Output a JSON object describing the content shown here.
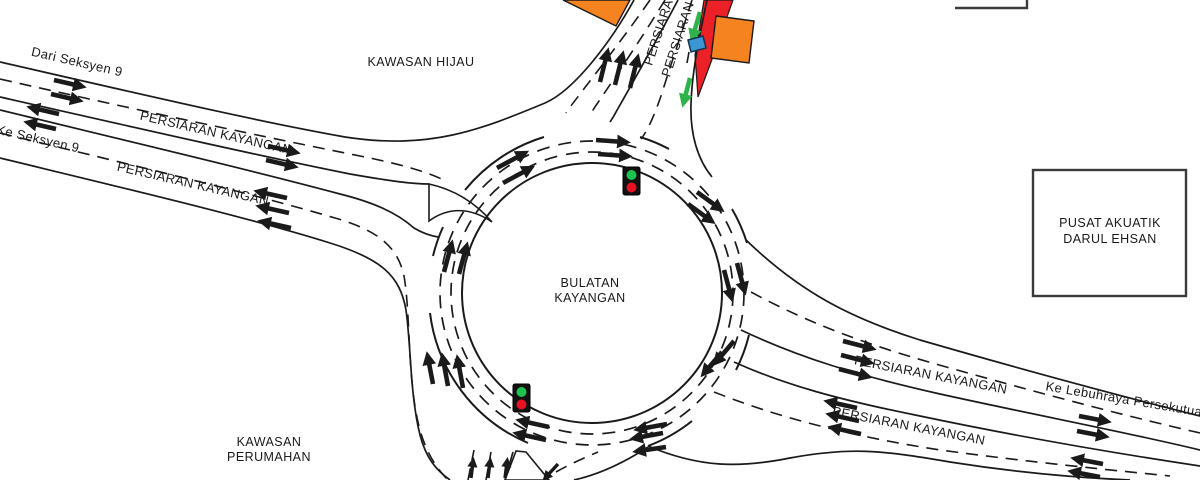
{
  "title": "Bulatan Kayangan roundabout traffic diagram",
  "palette": {
    "orange": "#F5831F",
    "red": "#EC2027",
    "green": "#2DB34A",
    "blue": "#3D96D4",
    "signal_green": "#1DC24F",
    "signal_red": "#E81123"
  },
  "areas": {
    "kawasan_hijau": "KAWASAN HIJAU",
    "kawasan_perumahan_line1": "KAWASAN",
    "kawasan_perumahan_line2": "PERUMAHAN",
    "pusat_akuatik_line1": "PUSAT AKUATIK",
    "pusat_akuatik_line2": "DARUL EHSAN"
  },
  "roundabout": {
    "name_line1": "BULATAN",
    "name_line2": "KAYANGAN"
  },
  "roads": {
    "west_in_label": "PERSIARAN KAYANGAN",
    "west_out_label": "PERSIARAN KAYANGAN",
    "east_out_label": "PERSIARAN KAYANGAN",
    "east_in_label": "PERSIARAN KAYANGAN",
    "north_left_label": "PERSIARAN",
    "north_right_label": "PERSIARAN H",
    "from_seksyen9": "Dari Seksyen 9",
    "to_seksyen9": "Ke Seksyen 9",
    "to_lebuhraya": "Ke Lebuhraya Persekutuan"
  },
  "signals": [
    {
      "id": "north-east-signal",
      "top": "green",
      "bottom": "red"
    },
    {
      "id": "south-west-signal",
      "top": "green",
      "bottom": "red"
    }
  ]
}
